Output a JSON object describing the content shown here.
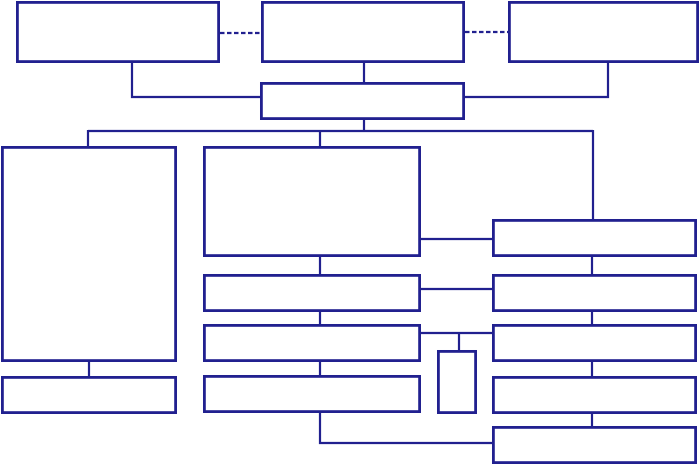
{
  "diagram": {
    "title": "",
    "canvas": {
      "width": 700,
      "height": 465,
      "background": "#ffffff"
    },
    "colors": {
      "stroke": "#21208f",
      "box_fill": "#ffffff"
    },
    "stroke_widths": {
      "box": 2.8,
      "line": 2.2
    },
    "dash_pattern": "4.5 2.5",
    "nodes": [
      {
        "id": "top-box-left",
        "label": "",
        "x": 16,
        "y": 1,
        "w": 204,
        "h": 62
      },
      {
        "id": "top-box-center",
        "label": "",
        "x": 261,
        "y": 1,
        "w": 204,
        "h": 62
      },
      {
        "id": "top-box-right",
        "label": "",
        "x": 508,
        "y": 1,
        "w": 191,
        "h": 62
      },
      {
        "id": "hub-box",
        "label": "",
        "x": 260,
        "y": 82,
        "w": 205,
        "h": 38
      },
      {
        "id": "left-tall-box",
        "label": "",
        "x": 1,
        "y": 146,
        "w": 176,
        "h": 216
      },
      {
        "id": "left-bottom-box",
        "label": "",
        "x": 1,
        "y": 376,
        "w": 176,
        "h": 38
      },
      {
        "id": "center-large-box",
        "label": "",
        "x": 203,
        "y": 146,
        "w": 218,
        "h": 111
      },
      {
        "id": "center-row-box-1",
        "label": "",
        "x": 203,
        "y": 274,
        "w": 218,
        "h": 38
      },
      {
        "id": "center-row-box-2",
        "label": "",
        "x": 203,
        "y": 324,
        "w": 218,
        "h": 38
      },
      {
        "id": "center-row-box-3",
        "label": "",
        "x": 203,
        "y": 375,
        "w": 218,
        "h": 38
      },
      {
        "id": "small-upright-box",
        "label": "",
        "x": 437,
        "y": 350,
        "w": 40,
        "h": 64
      },
      {
        "id": "right-row-box-1",
        "label": "",
        "x": 492,
        "y": 219,
        "w": 205,
        "h": 38
      },
      {
        "id": "right-row-box-2",
        "label": "",
        "x": 492,
        "y": 274,
        "w": 205,
        "h": 38
      },
      {
        "id": "right-row-box-3",
        "label": "",
        "x": 492,
        "y": 324,
        "w": 205,
        "h": 38
      },
      {
        "id": "right-row-box-4",
        "label": "",
        "x": 492,
        "y": 376,
        "w": 205,
        "h": 38
      },
      {
        "id": "right-row-box-5",
        "label": "",
        "x": 492,
        "y": 426,
        "w": 205,
        "h": 38
      }
    ],
    "connectors": [
      {
        "id": "dashed-link-left",
        "style": "dashed",
        "points": [
          [
            220,
            33
          ],
          [
            261,
            33
          ]
        ]
      },
      {
        "id": "dashed-link-right",
        "style": "dashed",
        "points": [
          [
            465,
            32
          ],
          [
            508,
            32
          ]
        ]
      },
      {
        "id": "top-left-elbow",
        "style": "solid",
        "points": [
          [
            132,
            63
          ],
          [
            132,
            97
          ],
          [
            260,
            97
          ]
        ]
      },
      {
        "id": "top-center-drop",
        "style": "solid",
        "points": [
          [
            364,
            63
          ],
          [
            364,
            82
          ]
        ]
      },
      {
        "id": "top-right-elbow",
        "style": "solid",
        "points": [
          [
            608,
            63
          ],
          [
            608,
            97
          ],
          [
            465,
            97
          ]
        ]
      },
      {
        "id": "hub-drop",
        "style": "solid",
        "points": [
          [
            364,
            120
          ],
          [
            364,
            131
          ]
        ]
      },
      {
        "id": "main-bus",
        "style": "solid",
        "points": [
          [
            88,
            131
          ],
          [
            593,
            131
          ]
        ]
      },
      {
        "id": "bus-drop-left",
        "style": "solid",
        "points": [
          [
            88,
            130
          ],
          [
            88,
            147
          ]
        ]
      },
      {
        "id": "bus-drop-center",
        "style": "solid",
        "points": [
          [
            320,
            130
          ],
          [
            320,
            147
          ]
        ]
      },
      {
        "id": "bus-drop-right",
        "style": "solid",
        "points": [
          [
            593,
            130
          ],
          [
            593,
            220
          ]
        ]
      },
      {
        "id": "left-column-link",
        "style": "solid",
        "points": [
          [
            89,
            361
          ],
          [
            89,
            377
          ]
        ]
      },
      {
        "id": "center-link-1",
        "style": "solid",
        "points": [
          [
            320,
            256
          ],
          [
            320,
            275
          ]
        ]
      },
      {
        "id": "center-link-2",
        "style": "solid",
        "points": [
          [
            320,
            311
          ],
          [
            320,
            325
          ]
        ]
      },
      {
        "id": "center-link-3",
        "style": "solid",
        "points": [
          [
            320,
            361
          ],
          [
            320,
            376
          ]
        ]
      },
      {
        "id": "center-right-link-1",
        "style": "solid",
        "points": [
          [
            420,
            239
          ],
          [
            493,
            239
          ]
        ]
      },
      {
        "id": "center-right-link-2",
        "style": "solid",
        "points": [
          [
            420,
            289
          ],
          [
            493,
            289
          ]
        ]
      },
      {
        "id": "center-right-link-3",
        "style": "solid",
        "points": [
          [
            420,
            333
          ],
          [
            493,
            333
          ]
        ]
      },
      {
        "id": "small-box-drop",
        "style": "solid",
        "points": [
          [
            459,
            332
          ],
          [
            459,
            351
          ]
        ]
      },
      {
        "id": "bottom-elbow",
        "style": "solid",
        "points": [
          [
            320,
            412
          ],
          [
            320,
            443
          ],
          [
            493,
            443
          ]
        ]
      },
      {
        "id": "right-column-link-1",
        "style": "solid",
        "points": [
          [
            592,
            256
          ],
          [
            592,
            275
          ]
        ]
      },
      {
        "id": "right-column-link-2",
        "style": "solid",
        "points": [
          [
            592,
            311
          ],
          [
            592,
            325
          ]
        ]
      },
      {
        "id": "right-column-link-3",
        "style": "solid",
        "points": [
          [
            592,
            361
          ],
          [
            592,
            377
          ]
        ]
      },
      {
        "id": "right-column-link-4",
        "style": "solid",
        "points": [
          [
            592,
            412
          ],
          [
            592,
            427
          ]
        ]
      }
    ]
  }
}
